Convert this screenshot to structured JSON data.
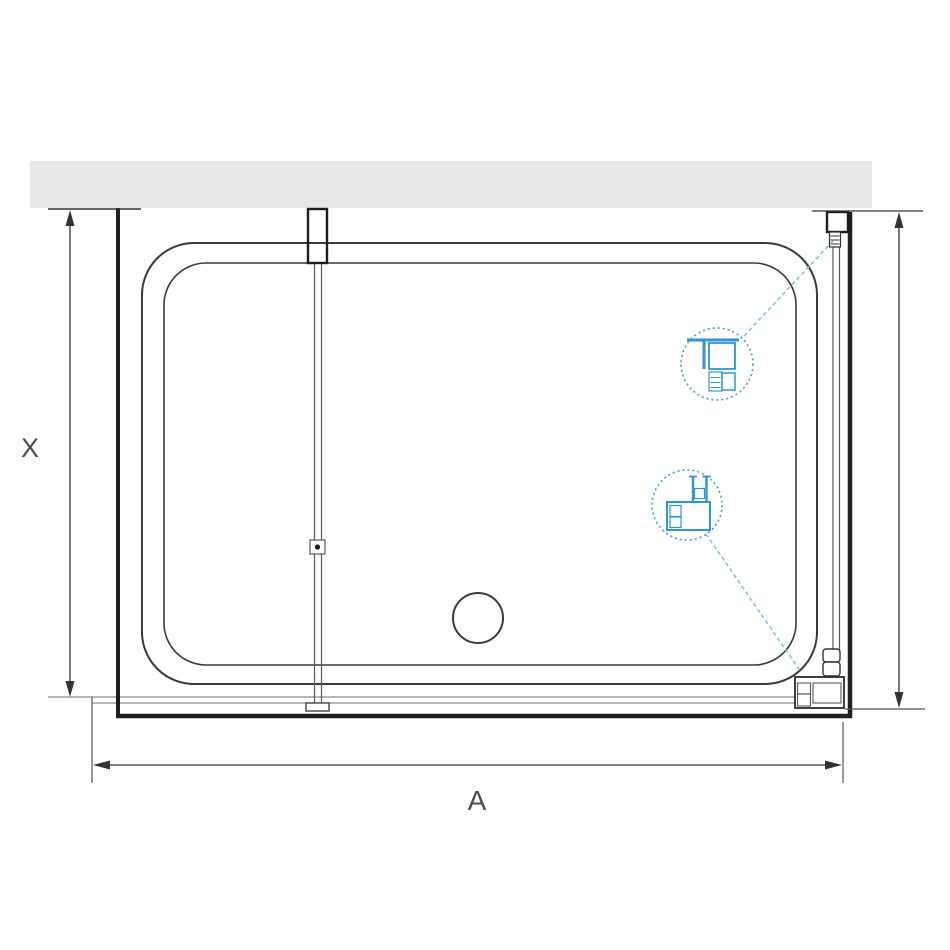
{
  "diagram": {
    "labels": {
      "dimension_x": "X",
      "dimension_a": "A"
    },
    "colors": {
      "wall_fill": "#e8e8e8",
      "structure_dark": "#1f1f1f",
      "tray_line": "#3a3a3a",
      "thin_line": "#8a8a8a",
      "detail_blue": "#2e96d5",
      "callout_circle_blue": "#4aa5da",
      "leader_blue": "#7cc3e8",
      "label_text": "#4b4c50"
    }
  }
}
